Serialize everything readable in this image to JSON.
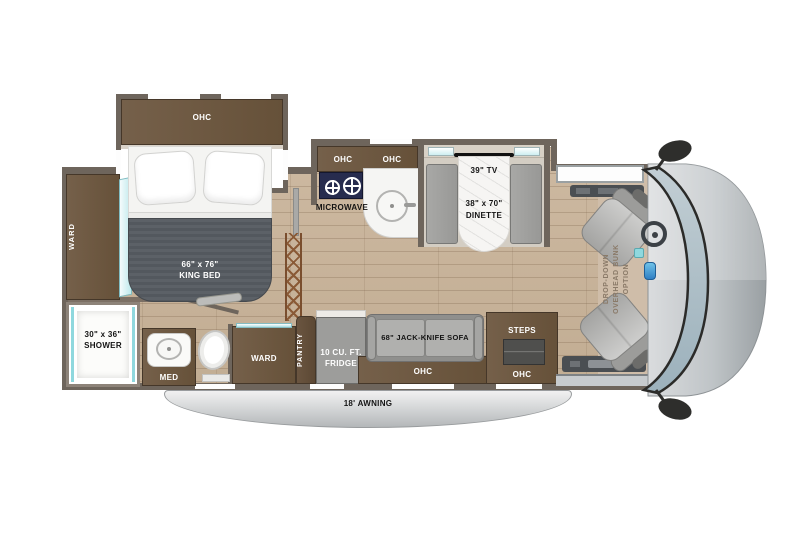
{
  "title": "Class C motorhome floor plan",
  "colors": {
    "wall": "#6e655c",
    "cabinet_wood": "#6e5a44",
    "floor_wood": "#c9b49b",
    "accent_teal": "#8fd8de",
    "seat_gray": "#b2b2b0",
    "cooktop_navy": "#272c4e",
    "awning_gray": "#c6c9cb"
  },
  "bedroom": {
    "ohc_label": "OHC",
    "ward_label": "WARD",
    "bed_size": "66\" x 76\"",
    "bed_name": "KING BED"
  },
  "bathroom": {
    "shower_size": "30\" x 36\"",
    "shower_name": "SHOWER",
    "med_label": "MED"
  },
  "kitchen": {
    "ohc_left_label": "OHC",
    "ohc_right_label": "OHC",
    "microwave_label": "MICROWAVE"
  },
  "dinette": {
    "tv_label": "39\" TV",
    "size_label": "38\" x 70\"",
    "name_label": "DINETTE"
  },
  "storage": {
    "ward_label": "WARD",
    "pantry_label": "PANTRY",
    "fridge_line1": "10 CU. FT.",
    "fridge_line2": "FRIDGE"
  },
  "living": {
    "sofa_label": "68\" JACK-KNIFE SOFA",
    "sofa_ohc_label": "OHC"
  },
  "entry": {
    "steps_label": "STEPS",
    "ohc_label": "OHC"
  },
  "cab": {
    "bunk_line1": "DROP-DOWN",
    "bunk_line2": "OVERHEAD BUNK",
    "bunk_line3": "OPTION"
  },
  "exterior": {
    "awning_label": "18' AWNING"
  }
}
